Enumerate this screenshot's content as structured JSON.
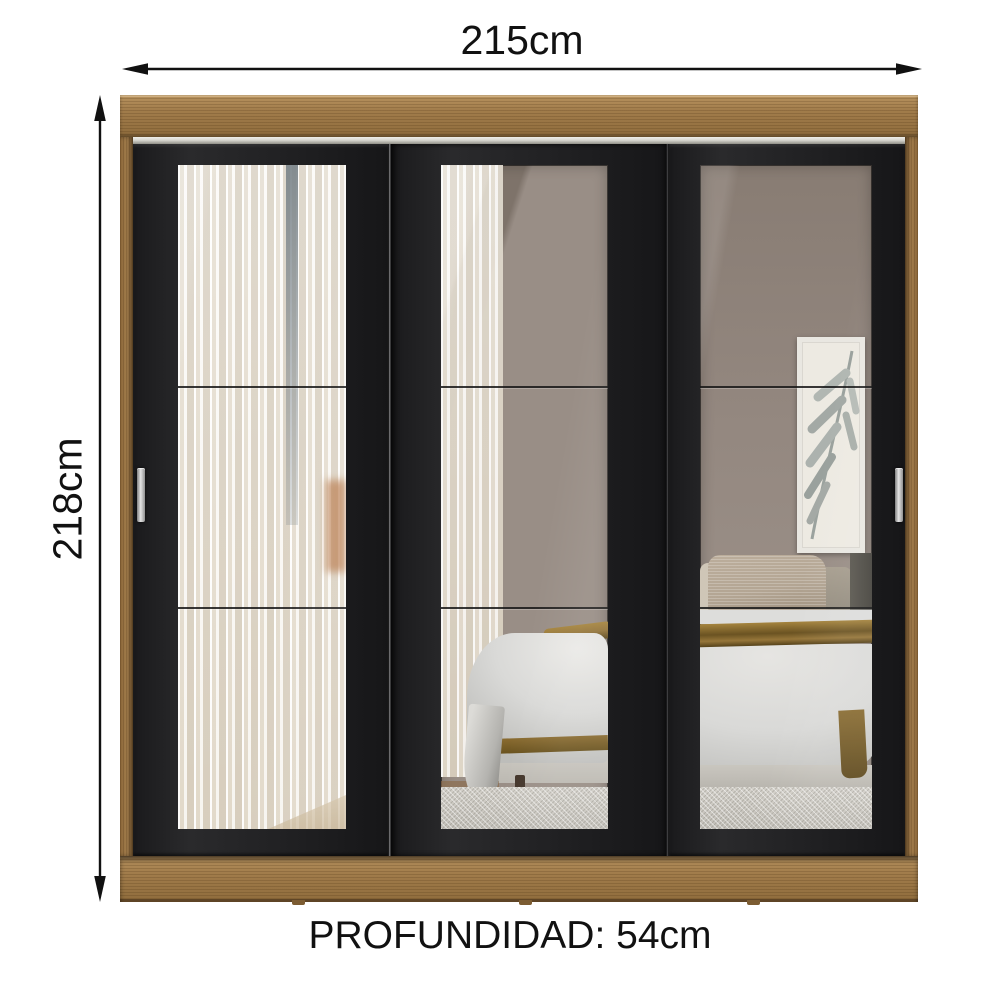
{
  "dimensions": {
    "width_label": "215cm",
    "height_label": "218cm",
    "depth_label": "PROFUNDIDAD: 54cm"
  },
  "colors": {
    "text": "#111111",
    "arrow": "#111111",
    "wood": "#a17c4b",
    "door": "#222224",
    "rail": "#d8d7d0",
    "mirror_wall": "#9a8f87",
    "curtain": "#e3dac9",
    "duvet": "#d9d9d7",
    "blanket_gold": "#93743a",
    "carpet": "#d3d0c9",
    "pillow_tan": "#b3a593",
    "brick": "#bb7f52"
  }
}
